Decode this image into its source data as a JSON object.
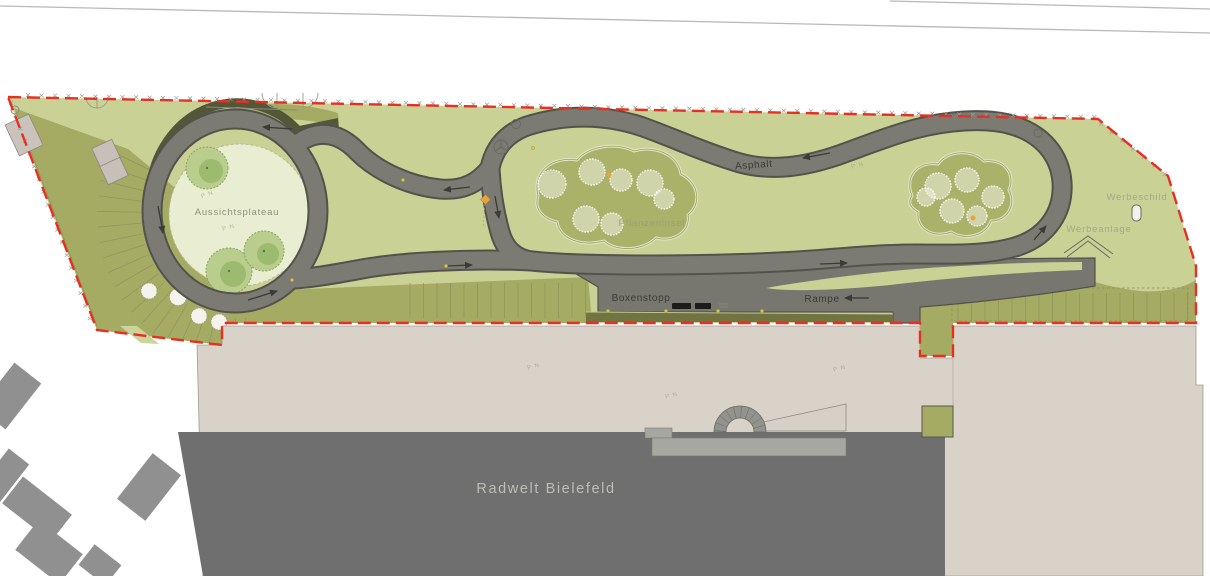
{
  "title": "Lageplan Pumptrack Radwelt Bielefeld",
  "labels": {
    "aussichtsplateau": "Aussichtsplateau",
    "pflanzeninsel": "Pflanzeninsel",
    "asphalt": "Asphalt",
    "boxenstopp": "Boxenstopp",
    "rampe": "Rampe",
    "werbeschild": "Werbeschild",
    "werbeanlage": "Werbeanlage",
    "building_name": "Radwelt Bielefeld"
  },
  "annotation": {
    "survey_mark": "P N"
  },
  "colors": {
    "site_green": "#cad194",
    "embankment_olive": "#a5ab63",
    "dark_roof_band": "#6f7440",
    "track_gray": "#7b7b73",
    "track_edge": "#53534c",
    "apron_gray": "#77776f",
    "boundary_red": "#e63022",
    "plateau_cream": "#e9edd1",
    "island_olive": "#aab168",
    "roof_beige": "#d9d2c9",
    "building_dark": "#6f6f6f",
    "accent_orange": "#e8a33d",
    "marker_yellow": "#d8c93a"
  },
  "symbols": {
    "boundary_fence_mark": "x-cross",
    "bench": "black-bar",
    "sign_board": "rounded-rect",
    "roof_chevron": "double-line-chevron",
    "utility_circle": "circled-three-spoke",
    "survey_circle": "small-open-circle",
    "orange_diamond": "diamond-marker"
  }
}
